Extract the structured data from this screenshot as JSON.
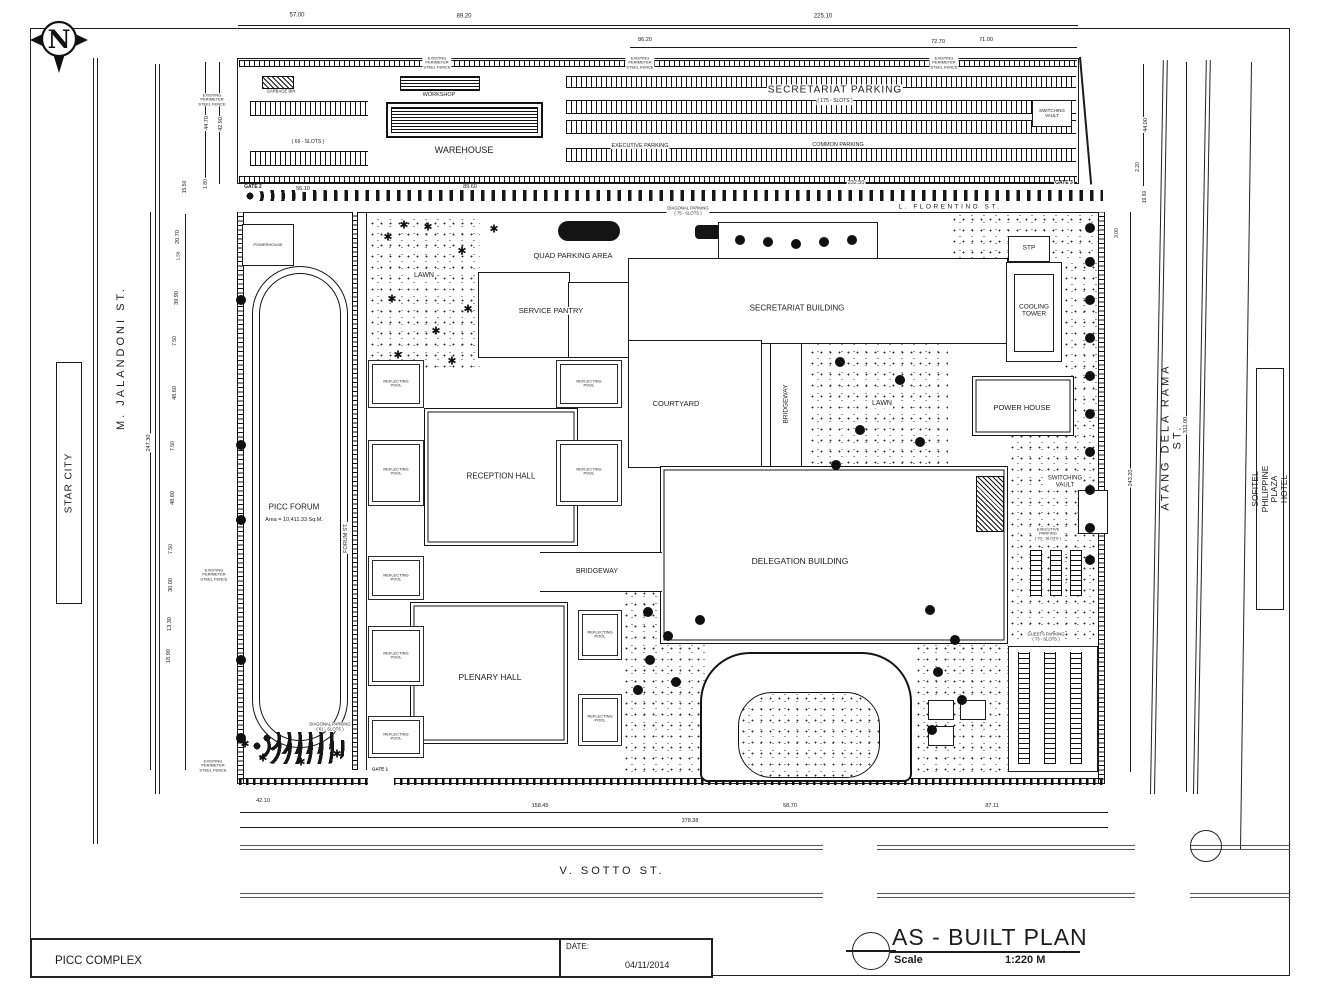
{
  "title_block": {
    "project": "PICC COMPLEX",
    "date_label": "DATE:",
    "date_value": "04/11/2014",
    "plan_title": "AS - BUILT  PLAN",
    "scale_label": "Scale",
    "scale_value": "1:220 M"
  },
  "north": {
    "letter": "N"
  },
  "icons": {
    "tree_glyph": "✱",
    "north_arrow": "compass-north"
  },
  "labels": [
    {
      "name": "dim-top-57",
      "text": "57.00",
      "x": 297,
      "y": 16,
      "size": 6
    },
    {
      "name": "dim-top-8920",
      "text": "89.20",
      "x": 464,
      "y": 17,
      "size": 6
    },
    {
      "name": "dim-top-22510",
      "text": "225.10",
      "x": 823,
      "y": 17,
      "size": 6
    },
    {
      "name": "dim-top-8620",
      "text": "86.20",
      "x": 645,
      "y": 40,
      "size": 5.5
    },
    {
      "name": "dim-top-7270",
      "text": "72.70",
      "x": 938,
      "y": 42,
      "size": 5.5
    },
    {
      "name": "dim-top-7100",
      "text": "71.00",
      "x": 986,
      "y": 40,
      "size": 5.5
    },
    {
      "name": "garbage-bin-label",
      "text": "GARBAGE BIN",
      "x": 281,
      "y": 92,
      "size": 4.2,
      "bg": 1
    },
    {
      "name": "slots-66-label",
      "text": "( 66 - SLOTS )",
      "x": 308,
      "y": 143,
      "size": 5,
      "bg": 1
    },
    {
      "name": "workshop-label",
      "text": "WORKSHOP",
      "x": 439,
      "y": 95,
      "size": 5.5,
      "bg": 1
    },
    {
      "name": "warehouse-label",
      "text": "WAREHOUSE",
      "x": 464,
      "y": 150,
      "size": 9,
      "bg": 1
    },
    {
      "name": "executive-parking-label",
      "text": "EXECUTIVE  PARKING",
      "x": 640,
      "y": 146,
      "size": 5.5,
      "bg": 1
    },
    {
      "name": "secretariat-parking-label",
      "text": "SECRETARIAT PARKING",
      "x": 835,
      "y": 90,
      "size": 10,
      "ls": 1,
      "bg": 1
    },
    {
      "name": "secretariat-parking-slots",
      "text": "( 175 - SLOTS )",
      "x": 835,
      "y": 102,
      "size": 5,
      "bg": 1
    },
    {
      "name": "common-parking-label",
      "text": "COMMON  PARKING",
      "x": 838,
      "y": 145,
      "size": 5.5,
      "bg": 1
    },
    {
      "name": "switching-vault-top-label",
      "text": "SWITCHING\nVAULT",
      "x": 1052,
      "y": 113,
      "size": 4.5,
      "bg": 1
    },
    {
      "name": "fence-note-1",
      "text": "EXISTING\nPERIMETER\nSTEEL FENCE",
      "x": 212,
      "y": 100,
      "size": 4,
      "bg": 1
    },
    {
      "name": "fence-note-2",
      "text": "EXISTING\nPERIMETER\nSTEEL FENCE",
      "x": 437,
      "y": 63,
      "size": 4,
      "bg": 1
    },
    {
      "name": "fence-note-3",
      "text": "EXISTING\nPERIMETER\nSTEEL FENCE",
      "x": 640,
      "y": 63,
      "size": 4,
      "bg": 1
    },
    {
      "name": "fence-note-4",
      "text": "EXISTING\nPERIMETER\nSTEEL FENCE",
      "x": 944,
      "y": 63,
      "size": 4,
      "bg": 1
    },
    {
      "name": "fence-note-5",
      "text": "EXISTING\nPERIMETER\nSTEEL FENCE",
      "x": 214,
      "y": 575,
      "size": 4,
      "bg": 1
    },
    {
      "name": "fence-note-6",
      "text": "EXISTING\nPERIMETER\nSTEEL FENCE",
      "x": 213,
      "y": 766,
      "size": 4,
      "bg": 1
    },
    {
      "name": "gate-2-label",
      "text": "GATE 2",
      "x": 253,
      "y": 188,
      "size": 5,
      "bold": 1,
      "bg": 1
    },
    {
      "name": "dim-5610",
      "text": "56.10",
      "x": 303,
      "y": 189,
      "size": 5.5,
      "bg": 1
    },
    {
      "name": "dim-8960",
      "text": "89.60",
      "x": 470,
      "y": 187,
      "size": 5.5,
      "bg": 1
    },
    {
      "name": "dim-23250",
      "text": "232.50",
      "x": 856,
      "y": 183,
      "size": 5.5,
      "bg": 1
    },
    {
      "name": "gate-3-label",
      "text": "GATE 3",
      "x": 1064,
      "y": 184,
      "size": 5,
      "bold": 1,
      "bg": 1
    },
    {
      "name": "florentino-street-label",
      "text": "L. FLORENTINO ST.",
      "x": 950,
      "y": 207,
      "size": 6.5,
      "ls": 2.5,
      "bg": 1
    },
    {
      "name": "diagonal-parking-75-label",
      "text": "DIAGONAL PARKING\n( 75 - SLOTS )",
      "x": 688,
      "y": 211,
      "size": 4.2,
      "bg": 1
    },
    {
      "name": "star-city-label",
      "text": "STAR CITY",
      "x": 69,
      "y": 483,
      "rot": -90,
      "size": 10,
      "ls": 1
    },
    {
      "name": "jalandoni-street-label",
      "text": "M.  JALANDONI  ST.",
      "x": 121,
      "y": 358,
      "rot": -90,
      "size": 11,
      "ls": 3
    },
    {
      "name": "dim-4470",
      "text": "44.70",
      "x": 207,
      "y": 123,
      "rot": -90,
      "size": 5.5,
      "bg": 1
    },
    {
      "name": "dim-4290",
      "text": "42.90",
      "x": 221,
      "y": 124,
      "rot": -90,
      "size": 5.5,
      "bg": 1
    },
    {
      "name": "dim-1550",
      "text": "15.50",
      "x": 186,
      "y": 187,
      "rot": -90,
      "size": 5,
      "bg": 1
    },
    {
      "name": "dim-180",
      "text": "1.80",
      "x": 207,
      "y": 184,
      "rot": -90,
      "size": 5,
      "bg": 1
    },
    {
      "name": "dim-2070",
      "text": "20.70",
      "x": 178,
      "y": 237,
      "rot": -90,
      "size": 5.5,
      "bg": 1
    },
    {
      "name": "dim-150",
      "text": "1.50",
      "x": 178,
      "y": 256,
      "rot": -90,
      "size": 4.5,
      "bg": 1
    },
    {
      "name": "dim-3990",
      "text": "39.90",
      "x": 177,
      "y": 298,
      "rot": -90,
      "size": 5.5,
      "bg": 1
    },
    {
      "name": "dim-750a",
      "text": "7.50",
      "x": 176,
      "y": 341,
      "rot": -90,
      "size": 5,
      "bg": 1
    },
    {
      "name": "dim-4860a",
      "text": "48.60",
      "x": 175,
      "y": 393,
      "rot": -90,
      "size": 5.5,
      "bg": 1
    },
    {
      "name": "dim-750b",
      "text": "7.50",
      "x": 174,
      "y": 446,
      "rot": -90,
      "size": 5,
      "bg": 1
    },
    {
      "name": "dim-4860b",
      "text": "48.60",
      "x": 173,
      "y": 498,
      "rot": -90,
      "size": 5.5,
      "bg": 1
    },
    {
      "name": "dim-750c",
      "text": "7.50",
      "x": 172,
      "y": 549,
      "rot": -90,
      "size": 5,
      "bg": 1
    },
    {
      "name": "dim-3000",
      "text": "30.00",
      "x": 171,
      "y": 585,
      "rot": -90,
      "size": 5.5,
      "bg": 1
    },
    {
      "name": "dim-1330",
      "text": "13.30",
      "x": 170,
      "y": 624,
      "rot": -90,
      "size": 5.5,
      "bg": 1
    },
    {
      "name": "dim-1890",
      "text": "18.90",
      "x": 169,
      "y": 656,
      "rot": -90,
      "size": 5.5,
      "bg": 1
    },
    {
      "name": "dim-24730",
      "text": "247.30",
      "x": 149,
      "y": 443,
      "rot": -90,
      "size": 5.5,
      "bg": 1
    },
    {
      "name": "powerhouse-label",
      "text": "POWERHOUSE",
      "x": 268,
      "y": 245,
      "size": 4,
      "bg": 1
    },
    {
      "name": "lawn-label-1",
      "text": "LAWN",
      "x": 424,
      "y": 276,
      "size": 7,
      "bg": 1
    },
    {
      "name": "quad-parking-label",
      "text": "QUAD PARKING AREA",
      "x": 573,
      "y": 256,
      "size": 7.5,
      "bg": 1
    },
    {
      "name": "service-pantry-label",
      "text": "SERVICE  PANTRY",
      "x": 551,
      "y": 311,
      "size": 7.5,
      "bg": 1
    },
    {
      "name": "secretariat-building-label",
      "text": "SECRETARIAT   BUILDING",
      "x": 797,
      "y": 309,
      "size": 8,
      "bg": 1
    },
    {
      "name": "stp-label",
      "text": "STP",
      "x": 1029,
      "y": 248,
      "size": 6.5
    },
    {
      "name": "cooling-tower-label",
      "text": "COOLING\nTOWER",
      "x": 1034,
      "y": 311,
      "size": 6.5,
      "bg": 1
    },
    {
      "name": "courtyard-label",
      "text": "COURTYARD",
      "x": 676,
      "y": 404,
      "size": 7.5
    },
    {
      "name": "bridgeway-v-label",
      "text": "BRIDGEWAY",
      "x": 786,
      "y": 404,
      "rot": -90,
      "size": 6.5,
      "bg": 1
    },
    {
      "name": "lawn-label-2",
      "text": "LAWN",
      "x": 882,
      "y": 404,
      "size": 7,
      "bg": 1
    },
    {
      "name": "power-house-label",
      "text": "POWER HOUSE",
      "x": 1022,
      "y": 408,
      "size": 7.5
    },
    {
      "name": "reception-hall-label",
      "text": "RECEPTION HALL",
      "x": 501,
      "y": 477,
      "size": 8
    },
    {
      "name": "picc-forum-label",
      "text": "PICC FORUM",
      "x": 294,
      "y": 508,
      "size": 8,
      "bg": 1
    },
    {
      "name": "picc-forum-area",
      "text": "Area = 10,411.33 Sq.M.",
      "x": 294,
      "y": 520,
      "size": 5.5,
      "bg": 1
    },
    {
      "name": "forum-street-label",
      "text": "FORUM   ST.",
      "x": 346,
      "y": 538,
      "rot": -90,
      "size": 5.5,
      "bg": 1
    },
    {
      "name": "switching-vault-label",
      "text": "SWITCHING\nVAULT",
      "x": 1065,
      "y": 482,
      "size": 6,
      "bg": 1
    },
    {
      "name": "executive-parking-20-label",
      "text": "EXECUTIVE\nPARKING\n( 20 - SLOTS )",
      "x": 1048,
      "y": 534,
      "size": 4,
      "bg": 1
    },
    {
      "name": "delegation-building-label",
      "text": "DELEGATION   BUILDING",
      "x": 800,
      "y": 562,
      "size": 8.5
    },
    {
      "name": "bridgeway-h-label",
      "text": "BRIDGEWAY",
      "x": 597,
      "y": 572,
      "size": 7,
      "bg": 1
    },
    {
      "name": "plenary-hall-label",
      "text": "PLENARY HALL",
      "x": 490,
      "y": 678,
      "size": 8.5
    },
    {
      "name": "guests-parking-label",
      "text": "GUESTS PARKING\n( 73 - SLOTS )",
      "x": 1046,
      "y": 637,
      "size": 4.2,
      "bg": 1
    },
    {
      "name": "diagonal-parking-61-label",
      "text": "DIAGONAL PARKING\n( 61 - SLOTS )",
      "x": 330,
      "y": 727,
      "size": 4.2,
      "bg": 1
    },
    {
      "name": "gate-1-label",
      "text": "GATE 1",
      "x": 380,
      "y": 769,
      "size": 4.5,
      "bold": 1,
      "bg": 1
    },
    {
      "name": "reflecting-pool-1",
      "text": "REFLECTING\nPOOL",
      "x": 396,
      "y": 384,
      "size": 4,
      "bg": 1
    },
    {
      "name": "reflecting-pool-2",
      "text": "REFLECTING\nPOOL",
      "x": 589,
      "y": 384,
      "size": 4,
      "bg": 1
    },
    {
      "name": "reflecting-pool-3",
      "text": "REFLECTING\nPOOL",
      "x": 396,
      "y": 472,
      "size": 4,
      "bg": 1
    },
    {
      "name": "reflecting-pool-4",
      "text": "REFLECTING\nPOOL",
      "x": 589,
      "y": 472,
      "size": 4,
      "bg": 1
    },
    {
      "name": "reflecting-pool-5",
      "text": "REFLECTING\nPOOL",
      "x": 396,
      "y": 578,
      "size": 4,
      "bg": 1
    },
    {
      "name": "reflecting-pool-6",
      "text": "REFLECTING\nPOOL",
      "x": 396,
      "y": 656,
      "size": 4,
      "bg": 1
    },
    {
      "name": "reflecting-pool-7",
      "text": "REFLECTING\nPOOL",
      "x": 396,
      "y": 737,
      "size": 4,
      "bg": 1
    },
    {
      "name": "reflecting-pool-8",
      "text": "REFLECTING\nPOOL",
      "x": 600,
      "y": 635,
      "size": 4,
      "bg": 1
    },
    {
      "name": "reflecting-pool-9",
      "text": "REFLECTING\nPOOL",
      "x": 600,
      "y": 719,
      "size": 4,
      "bg": 1
    },
    {
      "name": "atang-street-label",
      "text": "ATANG  DELA  RAMA  ST.",
      "x": 1172,
      "y": 437,
      "rot": -90,
      "size": 11,
      "ls": 3
    },
    {
      "name": "sofitel-label",
      "text": "SOFITEL PHILIPPINE PLAZA HOTEL",
      "x": 1270,
      "y": 489,
      "rot": -90,
      "size": 8.5
    },
    {
      "name": "dim-4400",
      "text": "44.00",
      "x": 1146,
      "y": 125,
      "rot": -90,
      "size": 5.5,
      "bg": 1
    },
    {
      "name": "dim-220",
      "text": "2.20",
      "x": 1139,
      "y": 167,
      "rot": -90,
      "size": 5,
      "bg": 1
    },
    {
      "name": "dim-1960",
      "text": "19.60",
      "x": 1146,
      "y": 197,
      "rot": -90,
      "size": 5,
      "bg": 1
    },
    {
      "name": "dim-300",
      "text": "3.00",
      "x": 1118,
      "y": 233,
      "rot": -90,
      "size": 5,
      "bg": 1
    },
    {
      "name": "dim-24320",
      "text": "243.20",
      "x": 1131,
      "y": 478,
      "rot": -90,
      "size": 5.5,
      "bg": 1
    },
    {
      "name": "dim-31100",
      "text": "311.00",
      "x": 1186,
      "y": 425,
      "rot": -90,
      "size": 5.5,
      "bg": 1
    },
    {
      "name": "dim-4210",
      "text": "42.10",
      "x": 263,
      "y": 801,
      "size": 5.5,
      "bg": 1
    },
    {
      "name": "dim-15845",
      "text": "158.45",
      "x": 540,
      "y": 806,
      "size": 5.5,
      "bg": 1
    },
    {
      "name": "dim-5870",
      "text": "58.70",
      "x": 790,
      "y": 806,
      "size": 5.5,
      "bg": 1
    },
    {
      "name": "dim-8711",
      "text": "87.11",
      "x": 992,
      "y": 806,
      "size": 5.5,
      "bg": 1
    },
    {
      "name": "dim-37838",
      "text": "378.38",
      "x": 690,
      "y": 821,
      "size": 5.5,
      "bg": 1
    },
    {
      "name": "sotto-street-label",
      "text": "V.  SOTTO  ST.",
      "x": 612,
      "y": 871,
      "size": 11,
      "ls": 3
    }
  ],
  "trees": {
    "round": [
      [
        241,
        300
      ],
      [
        241,
        445
      ],
      [
        241,
        520
      ],
      [
        241,
        660
      ],
      [
        241,
        738
      ],
      [
        1090,
        228
      ],
      [
        1090,
        262
      ],
      [
        1090,
        300
      ],
      [
        1090,
        338
      ],
      [
        1090,
        376
      ],
      [
        1090,
        414
      ],
      [
        1090,
        452
      ],
      [
        1090,
        490
      ],
      [
        1090,
        528
      ],
      [
        1090,
        560
      ],
      [
        648,
        612
      ],
      [
        668,
        636
      ],
      [
        650,
        660
      ],
      [
        676,
        682
      ],
      [
        700,
        620
      ],
      [
        638,
        690
      ],
      [
        930,
        610
      ],
      [
        955,
        640
      ],
      [
        938,
        672
      ],
      [
        962,
        700
      ],
      [
        932,
        730
      ],
      [
        840,
        362
      ],
      [
        900,
        380
      ],
      [
        860,
        430
      ],
      [
        920,
        442
      ],
      [
        836,
        465
      ],
      [
        740,
        240
      ],
      [
        768,
        242
      ],
      [
        796,
        244
      ],
      [
        824,
        242
      ],
      [
        852,
        240
      ]
    ],
    "star": [
      [
        388,
        238
      ],
      [
        428,
        228
      ],
      [
        462,
        252
      ],
      [
        392,
        300
      ],
      [
        436,
        332
      ],
      [
        468,
        310
      ],
      [
        398,
        356
      ],
      [
        452,
        362
      ],
      [
        404,
        226
      ],
      [
        494,
        230
      ],
      [
        245,
        745
      ],
      [
        263,
        759
      ],
      [
        301,
        763
      ],
      [
        337,
        755
      ]
    ]
  }
}
